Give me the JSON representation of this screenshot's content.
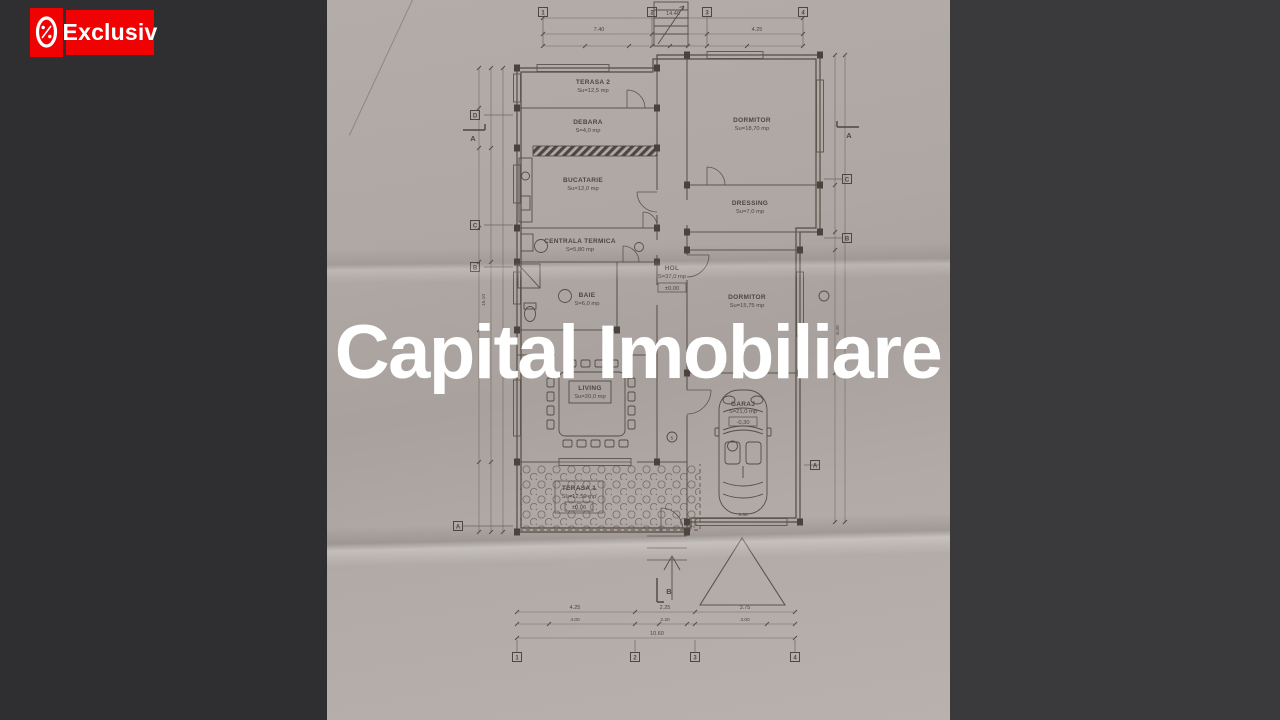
{
  "badge": {
    "label": "Exclusiv",
    "color": "#f10202"
  },
  "watermark": {
    "text": "Capital Imobiliare",
    "color": "#ffffff"
  },
  "plan": {
    "rooms": {
      "terasa2": {
        "name": "TERASA 2",
        "area": "Su=12,5 mp"
      },
      "debara": {
        "name": "DEBARA",
        "area": "S=4,0 mp"
      },
      "dormitor1": {
        "name": "DORMITOR",
        "area": "Su=18,70 mp"
      },
      "bucatarie": {
        "name": "BUCATARIE",
        "area": "Su=12,0 mp"
      },
      "dressing": {
        "name": "DRESSING",
        "area": "Su=7,0 mp"
      },
      "centrala": {
        "name": "CENTRALA TERMICA",
        "area": "S=5,80 mp"
      },
      "hol": {
        "name": "HOL",
        "area": "S=37,0 mp",
        "level": "±0,00"
      },
      "baie": {
        "name": "BAIE",
        "area": "S=6,0 mp"
      },
      "dormitor2": {
        "name": "DORMITOR",
        "area": "Su=15,75 mp"
      },
      "living": {
        "name": "LIVING",
        "area": "Su=20,0 mp"
      },
      "garaj": {
        "name": "GARAJ",
        "area": "S=21,0 mp",
        "level": "-0,30"
      },
      "terasa1": {
        "name": "TERASA 1",
        "area": "Su=12,50 mp",
        "level": "±0,06"
      }
    },
    "grid": {
      "top": [
        "1",
        "2",
        "3",
        "4"
      ],
      "bottom": [
        "1",
        "2",
        "3",
        "4"
      ],
      "left": [
        "D",
        "C",
        "B",
        "A"
      ],
      "right": [
        "C",
        "B",
        "A"
      ]
    },
    "sections": {
      "left": "A",
      "right": "A",
      "bottom": "B"
    },
    "dims": {
      "top_total": "14.40",
      "top_left": "7.40",
      "top_right": "4.25",
      "bottom_1": "4.25",
      "bottom_2": "2.25",
      "bottom_3": "3.75",
      "bottom_r2_1": "4.00",
      "bottom_r2_2": "2.20",
      "bottom_r2_3": "3.00",
      "bottom_total": "10.60",
      "garaj_w": "3.50",
      "left_total": "15.10",
      "right_v": "6.00"
    },
    "tags": {
      "t1": "5"
    }
  }
}
